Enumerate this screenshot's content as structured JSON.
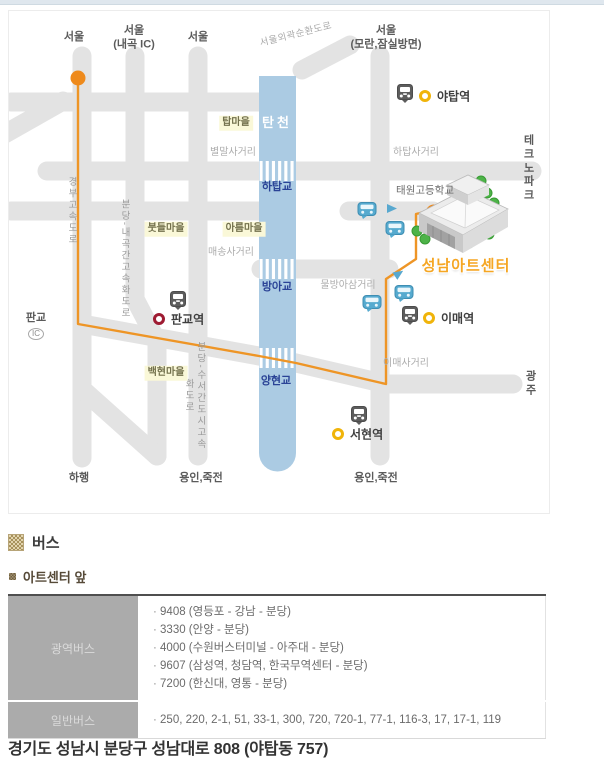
{
  "map": {
    "colors": {
      "road": "#e3e3e3",
      "river": "#abcbe3",
      "route": "#ee9526",
      "route_dot": "#ee8a1c",
      "bridge_label": "#2a4396",
      "village_bg": "#faf8d8",
      "center_label": "#f5a623",
      "bus_stop_blue": "#56aacf",
      "bundang_line_yellow": "#f0b40a",
      "sinbundang_line_red": "#9e1b32"
    },
    "center_name": "성남아트센터",
    "labels": [
      {
        "t": "서울",
        "x": 65,
        "y": 27,
        "c": "dark"
      },
      {
        "t": "서울\n(내곡 IC)",
        "x": 125,
        "y": 27,
        "c": "dark"
      },
      {
        "t": "서울",
        "x": 189,
        "y": 27,
        "c": "dark"
      },
      {
        "t": "서울\n(모란,잠실방면)",
        "x": 377,
        "y": 27,
        "c": "dark"
      },
      {
        "t": "서울외곽순환도로",
        "x": 287,
        "y": 24,
        "c": "roadname",
        "rot": -14
      },
      {
        "t": "탄천",
        "x": 268,
        "y": 112,
        "c": "river"
      },
      {
        "t": "탑마을",
        "x": 227,
        "y": 112,
        "c": "village"
      },
      {
        "t": "별말사거리",
        "x": 224,
        "y": 142,
        "c": "xgray"
      },
      {
        "t": "하탑사거리",
        "x": 407,
        "y": 142,
        "c": "xgray"
      },
      {
        "t": "테크노\n파크",
        "x": 520,
        "y": 158,
        "c": "dark"
      },
      {
        "t": "하탑교",
        "x": 268,
        "y": 177,
        "c": "bridge"
      },
      {
        "t": "태원고등학교",
        "x": 416,
        "y": 180,
        "c": "school"
      },
      {
        "t": "경부고속도로",
        "x": 62,
        "y": 200,
        "c": "vert"
      },
      {
        "t": "분당-내곡간고속화도로",
        "x": 115,
        "y": 248,
        "c": "vert"
      },
      {
        "t": "붓들마을",
        "x": 157,
        "y": 218,
        "c": "village"
      },
      {
        "t": "아름마을",
        "x": 235,
        "y": 218,
        "c": "village"
      },
      {
        "t": "매송사거리",
        "x": 222,
        "y": 242,
        "c": "xgray"
      },
      {
        "t": "방아교",
        "x": 268,
        "y": 277,
        "c": "bridge"
      },
      {
        "t": "물방아삼거리",
        "x": 339,
        "y": 275,
        "c": "xgray"
      },
      {
        "t": "성남아트센터",
        "x": 457,
        "y": 256,
        "c": "center"
      },
      {
        "t": "판교",
        "x": 27,
        "y": 308,
        "c": "dark"
      },
      {
        "t": "IC",
        "x": 27,
        "y": 323,
        "c": "ic"
      },
      {
        "t": "분당-수서간도시고속화도로",
        "x": 185,
        "y": 385,
        "c": "vert"
      },
      {
        "t": "백현마을",
        "x": 157,
        "y": 362,
        "c": "village"
      },
      {
        "t": "양현교",
        "x": 267,
        "y": 371,
        "c": "bridge"
      },
      {
        "t": "이매사거리",
        "x": 397,
        "y": 353,
        "c": "xgray"
      },
      {
        "t": "광주",
        "x": 522,
        "y": 373,
        "c": "dark"
      },
      {
        "t": "하행",
        "x": 70,
        "y": 468,
        "c": "dark"
      },
      {
        "t": "용인,죽전",
        "x": 192,
        "y": 468,
        "c": "dark"
      },
      {
        "t": "용인,죽전",
        "x": 367,
        "y": 468,
        "c": "dark"
      }
    ],
    "stations": [
      {
        "name": "야탑역",
        "ix": 396,
        "iy": 85,
        "rx": 416,
        "ry": 85,
        "ring": "#f0b40a",
        "lx": 428,
        "ly": 85
      },
      {
        "name": "판교역",
        "ix": 169,
        "iy": 292,
        "rx": 150,
        "ry": 308,
        "ring": "#9e1b32",
        "lx": 162,
        "ly": 308
      },
      {
        "name": "이매역",
        "ix": 401,
        "iy": 307,
        "rx": 420,
        "ry": 307,
        "ring": "#f0b40a",
        "lx": 432,
        "ly": 307
      },
      {
        "name": "서현역",
        "ix": 350,
        "iy": 407,
        "rx": 329,
        "ry": 423,
        "ring": "#f0b40a",
        "lx": 341,
        "ly": 423
      }
    ],
    "bus_stops": [
      [
        358,
        202
      ],
      [
        386,
        221
      ],
      [
        363,
        295
      ],
      [
        395,
        285
      ]
    ],
    "route_arrows": [
      {
        "x": 383,
        "y": 197,
        "rot": 0
      },
      {
        "x": 390,
        "y": 262,
        "rot": -33
      }
    ],
    "bridge_crossings_y": [
      160,
      258,
      347
    ]
  },
  "bus_section": {
    "title": "버스",
    "subtitle": "아트센터 앞",
    "table": {
      "rows": [
        {
          "header": "광역버스",
          "items": [
            "9408 (영등포 - 강남 - 분당)",
            "3330 (안양 - 분당)",
            "4000 (수원버스터미널 - 아주대 - 분당)",
            "9607 (삼성역, 청담역, 한국무역센터 - 분당)",
            "7200 (한신대, 영통 - 분당)"
          ]
        },
        {
          "header": "일반버스",
          "items": [
            "250, 220, 2-1, 51, 33-1, 300, 720, 720-1, 77-1, 116-3, 17, 17-1, 119"
          ]
        }
      ]
    }
  },
  "address": "경기도 성남시 분당구 성남대로 808 (야탑동 757)"
}
